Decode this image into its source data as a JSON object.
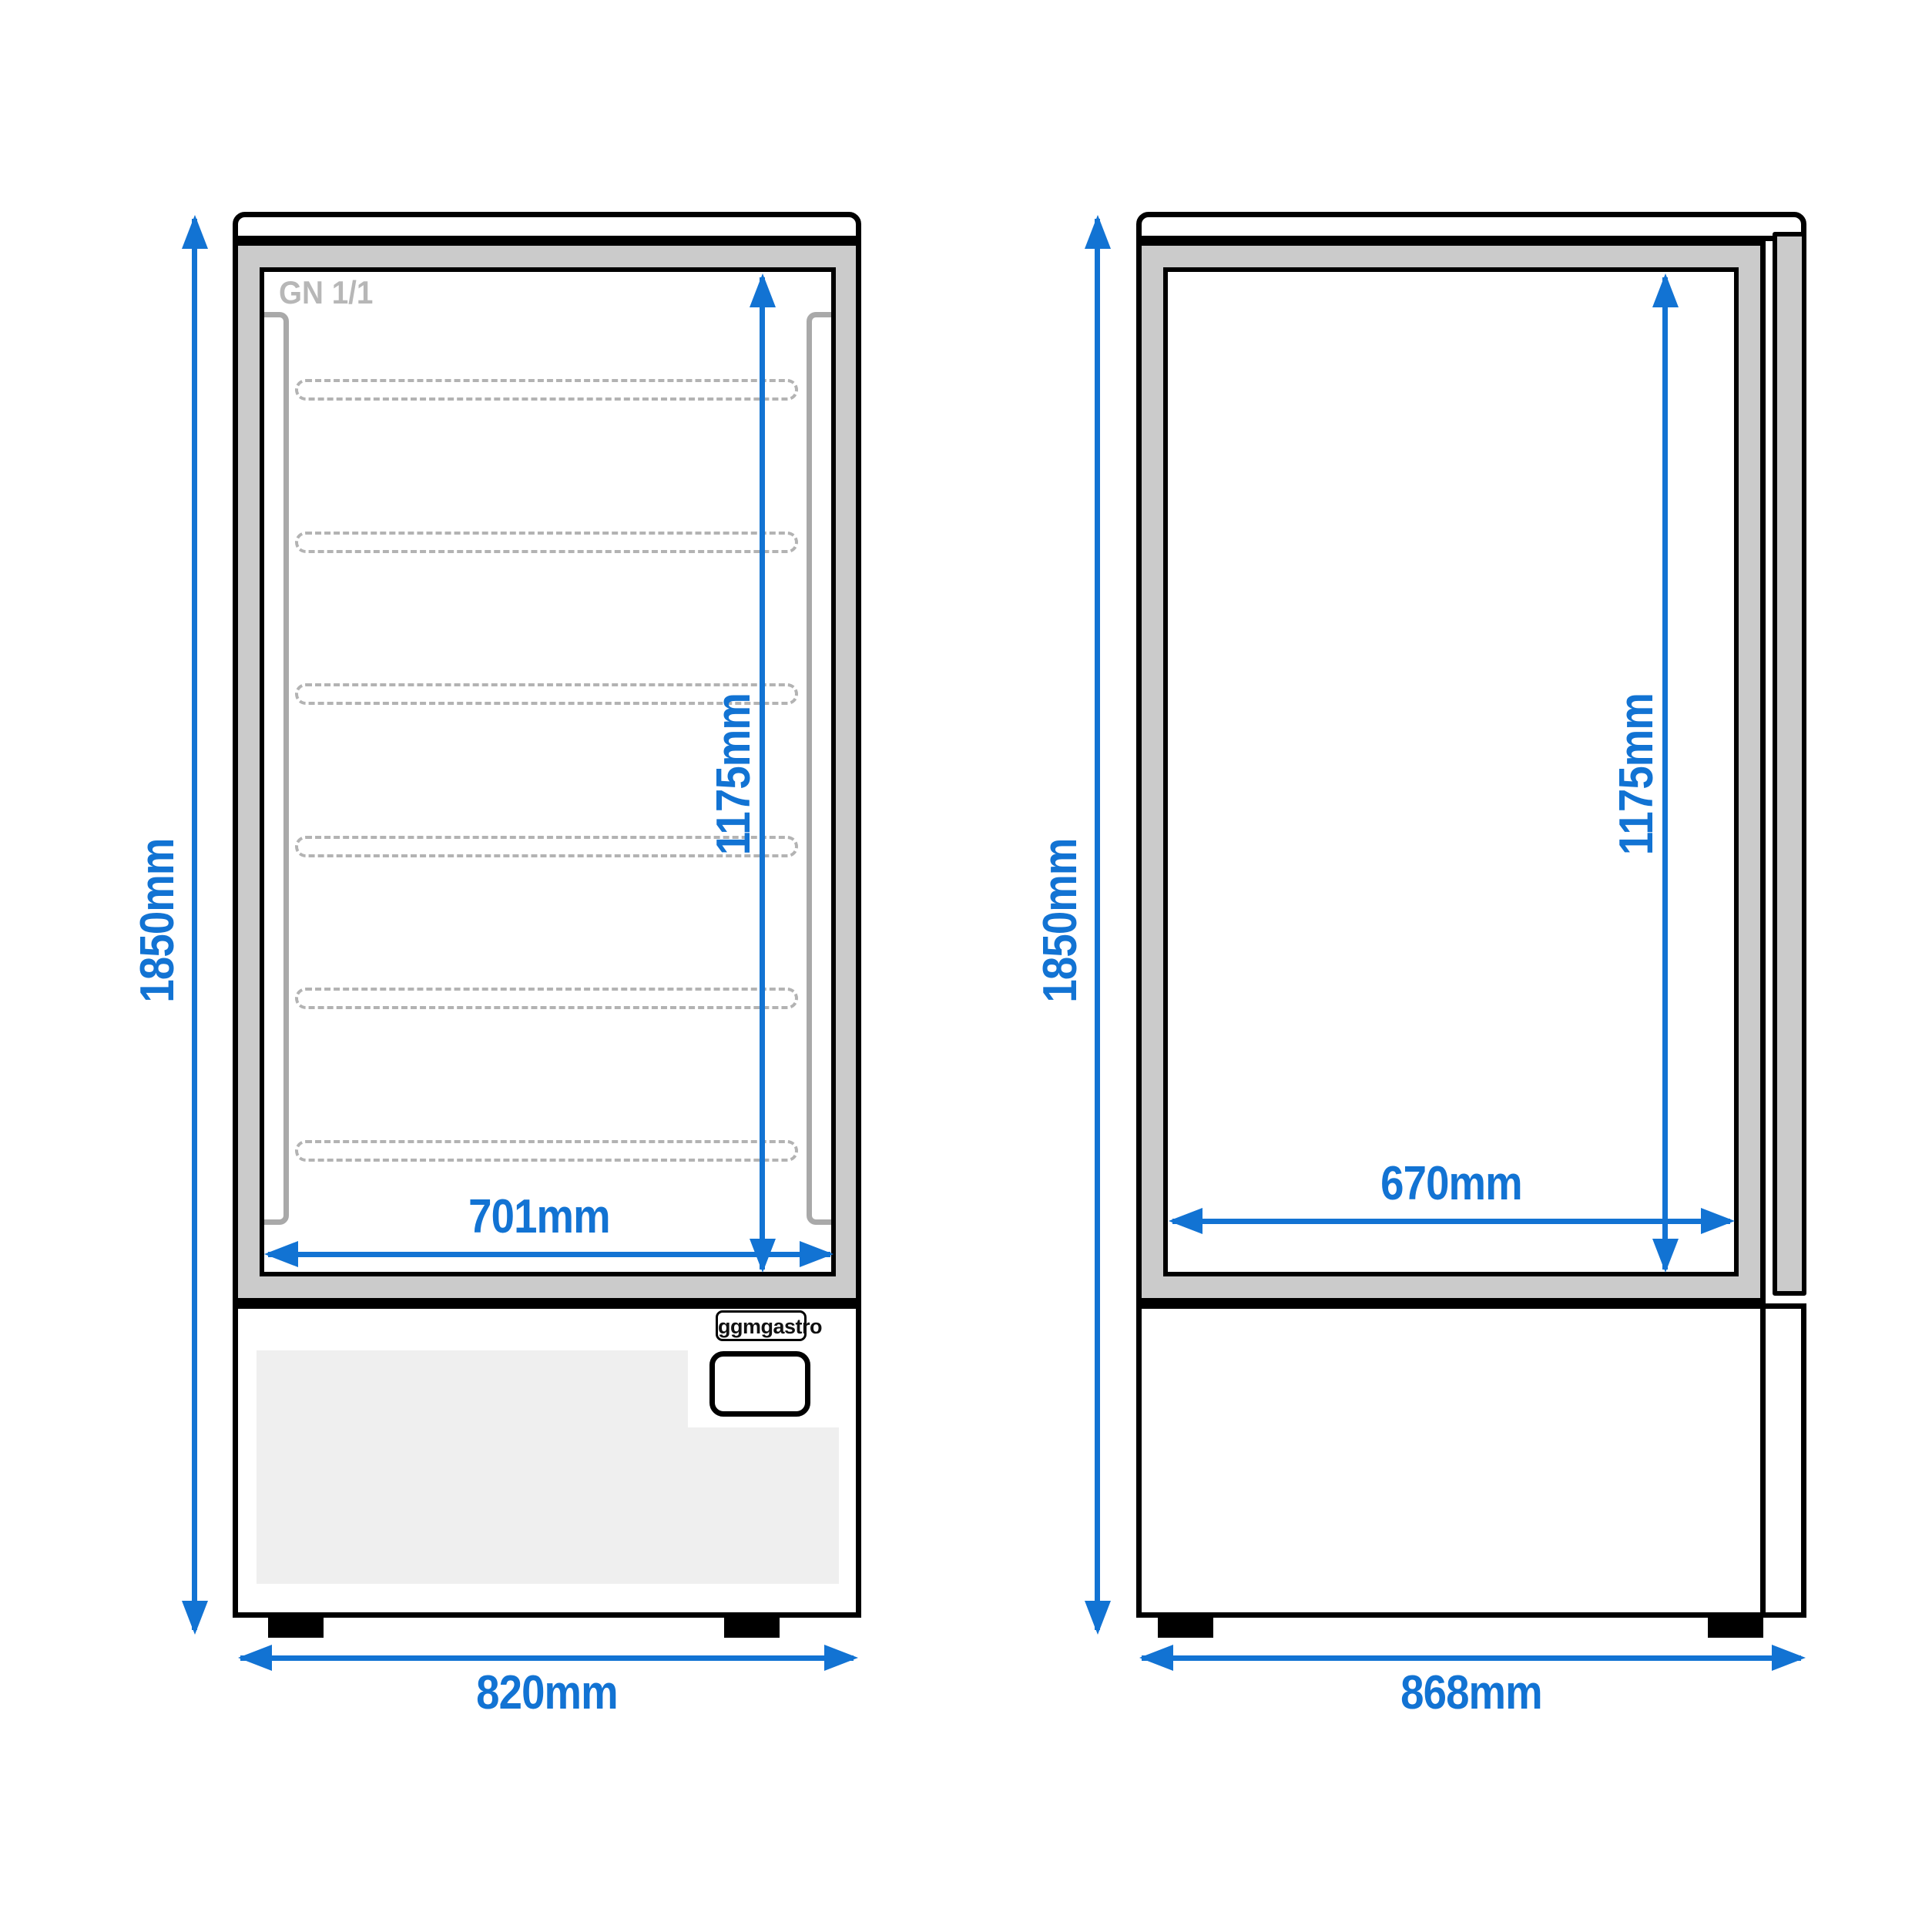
{
  "document_title": "Display cabinet technical dimension drawing",
  "colors": {
    "accent": "#1273d3",
    "cabinet_outline": "#000000",
    "frame_fill": "#cbcbcb",
    "panel_fill": "#efefef",
    "rail_gray": "#a9a9a9",
    "shelf_gray": "#b3b3b3",
    "interior_label_gray": "#b7b7b7"
  },
  "front_view": {
    "interior_label": "GN 1/1",
    "shelf_count": 6,
    "logo_label": "ggmgastro",
    "dimensions": {
      "overall_height": "1850mm",
      "inner_height": "1175mm",
      "inner_width": "701mm",
      "overall_width": "820mm"
    }
  },
  "side_view": {
    "dimensions": {
      "overall_height": "1850mm",
      "inner_height": "1175mm",
      "inner_depth": "670mm",
      "overall_depth": "868mm"
    }
  }
}
